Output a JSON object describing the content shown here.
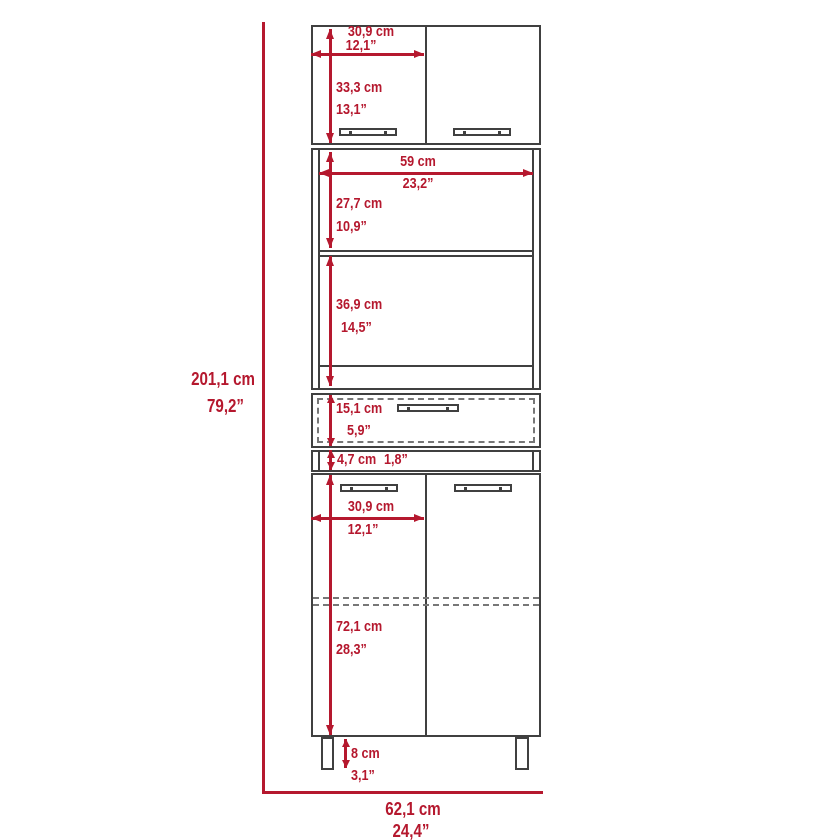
{
  "diagram": {
    "title": "pantry-cabinet-dimension-diagram",
    "colors": {
      "dimension_red": "#B5182E",
      "outline_gray": "#404040",
      "hidden_line_gray": "#777777",
      "background": "#FFFFFF"
    },
    "overall": {
      "height_cm": "201,1 cm",
      "height_in": "79,2”",
      "width_cm": "62,1 cm",
      "width_in": "24,4”"
    },
    "top_cabinet": {
      "door_width_cm": "30,9 cm",
      "door_width_in": "12,1”",
      "height_cm": "33,3 cm",
      "height_in": "13,1”"
    },
    "hutch": {
      "width_cm": "59 cm",
      "width_in": "23,2”",
      "upper_space_height_cm": "27,7 cm",
      "upper_space_height_in": "10,9”",
      "lower_space_height_cm": "36,9 cm",
      "lower_space_height_in": "14,5”"
    },
    "drawer": {
      "height_cm": "15,1 cm",
      "height_in": "5,9”"
    },
    "spacer": {
      "height_cm": "4,7 cm",
      "height_in": "1,8”"
    },
    "base_cabinet": {
      "door_width_cm": "30,9 cm",
      "door_width_in": "12,1”",
      "height_cm": "72,1 cm",
      "height_in": "28,3”"
    },
    "legs": {
      "height_cm": "8 cm",
      "height_in": "3,1”"
    }
  }
}
